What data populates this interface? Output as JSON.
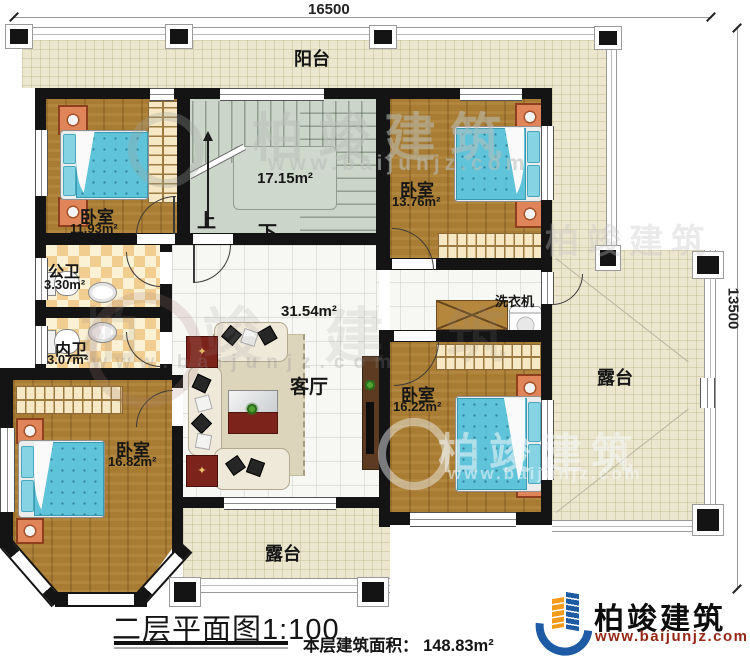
{
  "dimensions": {
    "top": "16500",
    "right": "13500"
  },
  "rooms": {
    "balcony": {
      "name": "阳台"
    },
    "bedroom_nw": {
      "name": "卧室",
      "area": "11.93m²"
    },
    "stairwell": {
      "area": "17.15m²",
      "up": "上",
      "down": "下"
    },
    "bedroom_ne": {
      "name": "卧室",
      "area": "13.76m²"
    },
    "bath_public": {
      "name": "公卫",
      "area": "3.30m²"
    },
    "bath_inner": {
      "name": "内卫",
      "area": "3.07m²"
    },
    "hall": {
      "area": "31.54m²"
    },
    "living": {
      "name": "客厅"
    },
    "bedroom_se": {
      "name": "卧室",
      "area": "16.22m²"
    },
    "bedroom_sw": {
      "name": "卧室",
      "area": "16.82m²"
    },
    "terrace_east": {
      "name": "露台"
    },
    "terrace_south": {
      "name": "露台"
    },
    "washer": {
      "name": "洗衣机"
    }
  },
  "watermark": {
    "brand": "柏竣建筑",
    "url": "www.baijunjz.com"
  },
  "footer": {
    "title": "二层平面图1:100",
    "area_note": "本层建筑面积： 148.83m²"
  },
  "logo": {
    "brand": "柏竣建筑",
    "url": "www.baijunjz.com"
  },
  "colors": {
    "wall": "#141414",
    "wood_floor": "#a87c33",
    "tile_beige": "#ebe7cf",
    "stair_floor": "#ccd5ca",
    "bath_checker": "#f1cd90",
    "bed_cyan": "#5fc3da",
    "logo_blue": "#1d5ba4",
    "logo_orange": "#f39c1b",
    "logo_url_red": "#942716"
  }
}
